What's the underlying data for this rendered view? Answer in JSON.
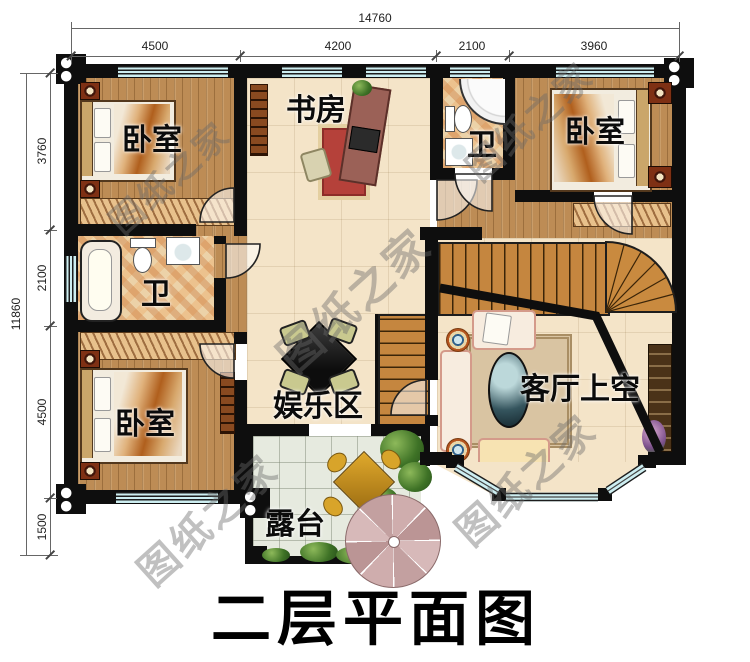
{
  "title": {
    "text": "二层平面图"
  },
  "watermark": {
    "text": "图纸之家"
  },
  "dimensions": {
    "top": {
      "total": "14760",
      "segments": [
        "4500",
        "4200",
        "2100",
        "3960"
      ]
    },
    "left": {
      "total": "11860",
      "segments": [
        "3760",
        "2100",
        "4500",
        "1500"
      ]
    }
  },
  "rooms": {
    "bedroom_top_left": {
      "label": "卧室"
    },
    "study": {
      "label": "书房"
    },
    "bath_top": {
      "label": "卫"
    },
    "bedroom_top_right": {
      "label": "卧室"
    },
    "bath_left": {
      "label": "卫"
    },
    "bedroom_bottom_left": {
      "label": "卧室"
    },
    "entertainment": {
      "label": "娱乐区"
    },
    "living_void": {
      "label": "客厅上空"
    },
    "terrace": {
      "label": "露台"
    }
  },
  "colors": {
    "wall": "#0e0e0e",
    "window_glass": "#cdeef1",
    "wood_floor": "#bd8c55",
    "pale_floor": "#f4e4c8",
    "bath_tile": "#ecd2a8",
    "stairs": "#c5863f",
    "terrace_tile": "#e6eadf",
    "umbrella": "#c9a6a6",
    "plant_green": "#3e7226",
    "watermark_gray": "#696969"
  }
}
